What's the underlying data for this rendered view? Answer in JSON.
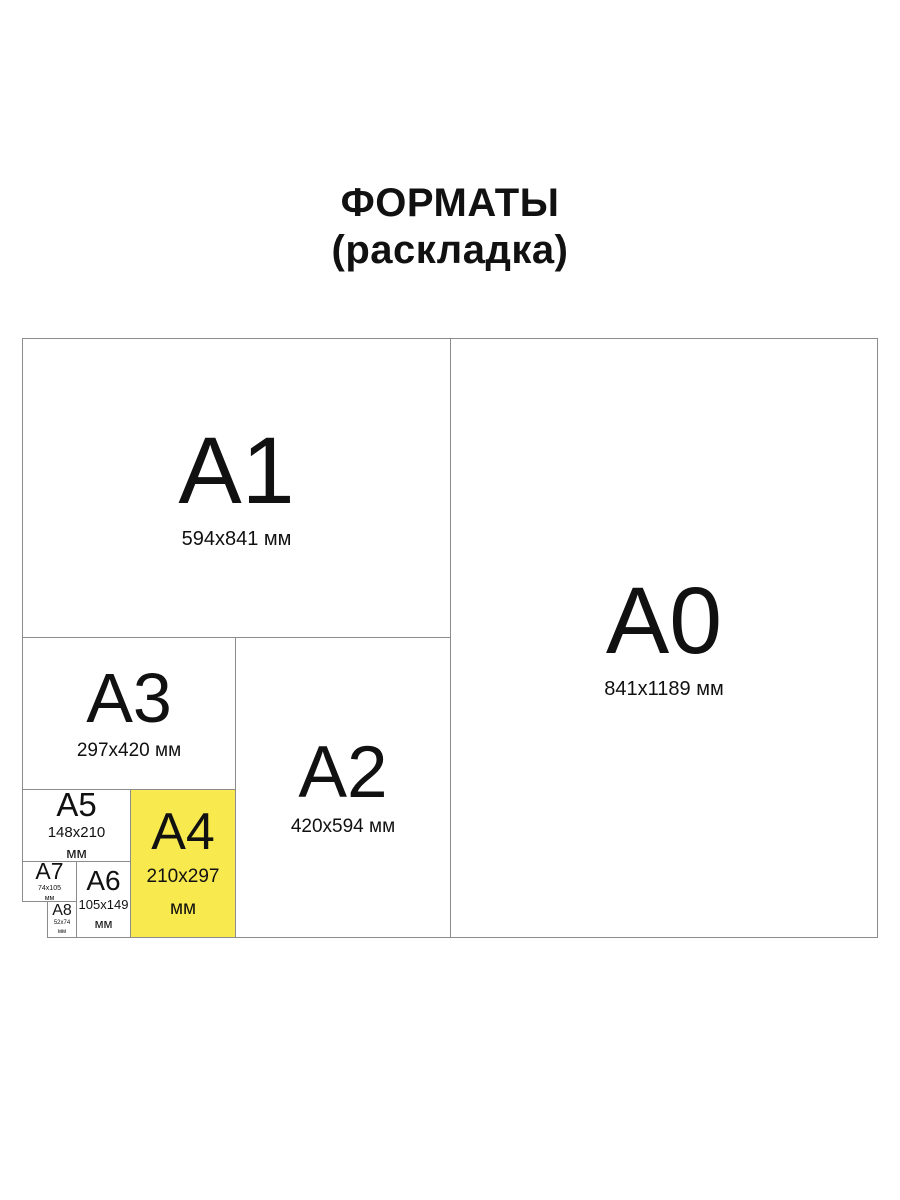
{
  "title": {
    "line1": "ФОРМАТЫ",
    "line2": "(раскладка)"
  },
  "colors": {
    "highlight": "#F7E94E",
    "border": "#8C8C8C",
    "text": "#111111",
    "background": "#FFFFFF"
  },
  "formats": {
    "a0": {
      "name": "A0",
      "dims": "841x1189 мм",
      "highlighted": false
    },
    "a1": {
      "name": "A1",
      "dims": "594x841 мм",
      "highlighted": false
    },
    "a2": {
      "name": "A2",
      "dims": "420x594 мм",
      "highlighted": false
    },
    "a3": {
      "name": "A3",
      "dims": "297x420 мм",
      "highlighted": false
    },
    "a4": {
      "name": "A4",
      "dims_line1": "210x297",
      "dims_line2": "мм",
      "highlighted": true
    },
    "a5": {
      "name": "A5",
      "dims_line1": "148x210",
      "dims_line2": "мм",
      "highlighted": false
    },
    "a6": {
      "name": "A6",
      "dims_line1": "105x149",
      "dims_line2": "мм",
      "highlighted": false
    },
    "a7": {
      "name": "A7",
      "dims_line1": "74x105",
      "dims_line2": "мм",
      "highlighted": false
    },
    "a8": {
      "name": "A8",
      "dims_line1": "52x74",
      "dims_line2": "мм",
      "highlighted": false
    }
  }
}
